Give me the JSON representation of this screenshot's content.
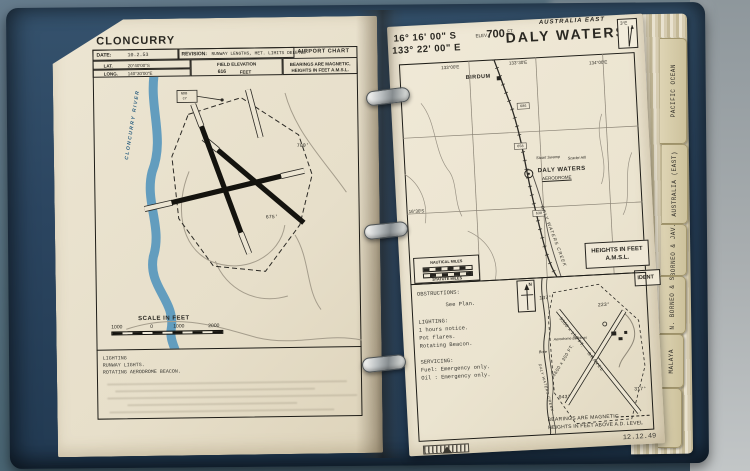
{
  "binder": {
    "tabs": [
      {
        "label": "PACIFIC OCEAN"
      },
      {
        "label": "AUSTRALIA (EAST)"
      },
      {
        "label": "BORNEO & JAV."
      },
      {
        "label": "BR. N. BORNEO & SAR."
      },
      {
        "label": "MALAYA"
      },
      {
        "label": ""
      }
    ]
  },
  "cloncurry": {
    "title": "CLONCURRY",
    "chart_type": "AIRPORT CHART",
    "date_label": "DATE:",
    "date": "10.2.53",
    "revision_label": "REVISION:",
    "revision": "RUNWAY LENGTHS, MET. LIMITS DELETED",
    "lat_label": "LAT.",
    "lat": "20°40'00\"S",
    "long_label": "LONG.",
    "long": "140°30'00\"E",
    "elevation_label": "FIELD ELEVATION",
    "elevation": "616",
    "elevation_unit": "FEET",
    "bearings_note": "BEARINGS ARE MAGNETIC,",
    "heights_note": "HEIGHTS IN FEET A.M.S.L.",
    "ndb_line1": "NDB",
    "ndb_line2": "CY",
    "river": "CLONCURRY RIVER",
    "spot_height_1": "700'",
    "spot_height_2": "675'",
    "scale_title": "SCALE IN FEET",
    "scale_ticks": [
      "1000",
      "0",
      "1000",
      "2000"
    ],
    "lighting_heading": "LIGHTING",
    "lighting_line1": "RUNWAY LIGHTS.",
    "lighting_line2": "ROTATING AERODROME BEACON."
  },
  "daly_waters": {
    "region": "AUSTRALIA EAST",
    "title": "DALY WATERS",
    "lat": "16° 16' 00\" S",
    "long": "133° 22' 00\" E",
    "elev_label": "ELEV.",
    "elev": "700",
    "elev_unit": "FT.",
    "variation": "3°E",
    "map": {
      "meridian_1": "133°00'E",
      "meridian_2": "133°30'E",
      "meridian_3": "134°00'E",
      "parallel": "16°30'S",
      "town": "BIRDUM",
      "swamp": "Stuart Swamp",
      "hill": "Scarlet Hill",
      "aerodrome_line1": "DALY WATERS",
      "aerodrome_line2": "AERODROME",
      "creek": "DALY WATERS CREEK",
      "height_1": "686",
      "height_2": "658",
      "height_3": "638",
      "scale_nautical": "NAUTICAL MILES",
      "scale_statute": "STATUTE MILES",
      "heights_box_line1": "HEIGHTS IN FEET",
      "heights_box_line2": "A.M.S.L.",
      "ident": "IDENT"
    },
    "info": {
      "obstructions_heading": "OBSTRUCTIONS:",
      "obstructions": "See Plan.",
      "lighting_heading": "LIGHTING:",
      "lighting_1": "1 hours notice.",
      "lighting_2": "Pot flares.",
      "lighting_3": "Rotating Beacon.",
      "servicing_heading": "SERVICING:",
      "servicing_1": "Fuel: Emergency only.",
      "servicing_2": "Oil : Emergency only."
    },
    "plan": {
      "north": "N",
      "runway_a": "5300 x 150 FT.",
      "runway_a2": "GRAVEL",
      "runway_b": "4600 x 300 FT.",
      "brg_nw": "137°",
      "brg_ne": "223°",
      "brg_sw": "043°",
      "brg_se": "317°",
      "buildings": "Aerodrome Buildings",
      "bore": "Bore",
      "creek": "DALY WATERS CREEK",
      "note1": "BEARINGS ARE MAGNETIC",
      "note2": "HEIGHTS IN FEET ABOVE A.D. LEVEL"
    },
    "date": "12.12.49"
  }
}
